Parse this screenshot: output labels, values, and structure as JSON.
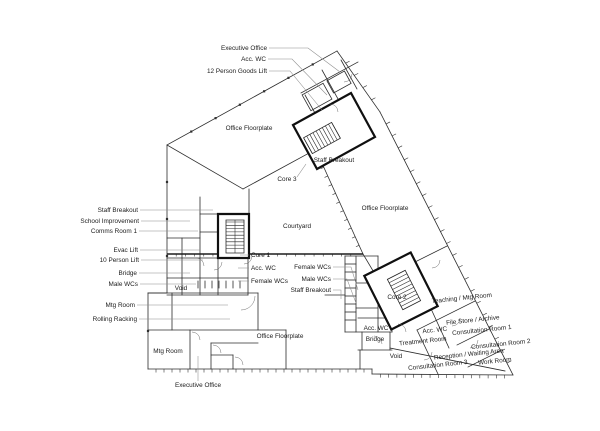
{
  "figure": {
    "type": "architectural-floor-plan",
    "background": "#ffffff",
    "wall_color": "#2b2b2b",
    "text_color": "#1c1c1c"
  },
  "labels": [
    {
      "id": "executive-office-top",
      "text": "Executive Office",
      "x": 267,
      "y": 50,
      "anchor": "end",
      "leader": [
        [
          269,
          48
        ],
        [
          308,
          48
        ],
        [
          340,
          72
        ]
      ]
    },
    {
      "id": "acc-wc-top",
      "text": "Acc. WC",
      "x": 266,
      "y": 61,
      "anchor": "end",
      "leader": [
        [
          268,
          59
        ],
        [
          292,
          59
        ],
        [
          327,
          95
        ]
      ]
    },
    {
      "id": "goods-lift",
      "text": "12 Person Goods Lift",
      "x": 267,
      "y": 73,
      "anchor": "end",
      "leader": [
        [
          269,
          71
        ],
        [
          290,
          71
        ],
        [
          322,
          110
        ]
      ]
    },
    {
      "id": "office-floorplate-nw",
      "text": "Office Floorplate",
      "x": 249,
      "y": 130,
      "anchor": "middle"
    },
    {
      "id": "staff-breakout-core3",
      "text": "Staff Breakout",
      "x": 334,
      "y": 162,
      "anchor": "middle"
    },
    {
      "id": "core-3",
      "text": "Core 3",
      "x": 287,
      "y": 181,
      "anchor": "middle",
      "leader": [
        [
          297,
          177
        ],
        [
          306,
          164
        ]
      ]
    },
    {
      "id": "office-floorplate-east",
      "text": "Office Floorplate",
      "x": 385,
      "y": 210,
      "anchor": "middle"
    },
    {
      "id": "staff-breakout-west",
      "text": "Staff Breakout",
      "x": 138,
      "y": 212,
      "anchor": "end",
      "leader": [
        [
          140,
          210
        ],
        [
          213,
          210
        ]
      ]
    },
    {
      "id": "school-improvement",
      "text": "School Improvement",
      "x": 139,
      "y": 223,
      "anchor": "end",
      "leader": [
        [
          141,
          221
        ],
        [
          190,
          221
        ]
      ]
    },
    {
      "id": "comms-room-1",
      "text": "Comms Room 1",
      "x": 137,
      "y": 233,
      "anchor": "end",
      "leader": [
        [
          139,
          231
        ],
        [
          198,
          231
        ]
      ]
    },
    {
      "id": "evac-lift",
      "text": "Evac Lift",
      "x": 138,
      "y": 252,
      "anchor": "end",
      "leader": [
        [
          140,
          250
        ],
        [
          200,
          250
        ]
      ]
    },
    {
      "id": "ten-person-lift",
      "text": "10 Person Lift",
      "x": 139,
      "y": 262,
      "anchor": "end",
      "leader": [
        [
          141,
          260
        ],
        [
          203,
          260
        ]
      ]
    },
    {
      "id": "bridge-west",
      "text": "Bridge",
      "x": 137,
      "y": 275,
      "anchor": "end",
      "leader": [
        [
          139,
          273
        ],
        [
          190,
          273
        ]
      ]
    },
    {
      "id": "male-wcs-west",
      "text": "Male WCs",
      "x": 138,
      "y": 286,
      "anchor": "end",
      "leader": [
        [
          140,
          284
        ],
        [
          196,
          284
        ]
      ]
    },
    {
      "id": "void-west",
      "text": "Void",
      "x": 181,
      "y": 290,
      "anchor": "middle"
    },
    {
      "id": "mtg-room-north",
      "text": "Mtg Room",
      "x": 135,
      "y": 307,
      "anchor": "end",
      "leader": [
        [
          137,
          305
        ],
        [
          228,
          305
        ]
      ]
    },
    {
      "id": "rolling-racking",
      "text": "Rolling Racking",
      "x": 137,
      "y": 321,
      "anchor": "end",
      "leader": [
        [
          139,
          319
        ],
        [
          230,
          319
        ]
      ]
    },
    {
      "id": "mtg-room-south",
      "text": "Mtg Room",
      "x": 168,
      "y": 353,
      "anchor": "middle"
    },
    {
      "id": "executive-office-south",
      "text": "Executive Office",
      "x": 198,
      "y": 387,
      "anchor": "middle",
      "leader": [
        [
          198,
          381
        ],
        [
          198,
          356
        ]
      ]
    },
    {
      "id": "courtyard",
      "text": "Courtyard",
      "x": 297,
      "y": 228,
      "anchor": "middle"
    },
    {
      "id": "core-1",
      "text": "Core 1",
      "x": 251,
      "y": 257,
      "anchor": "start",
      "leader": [
        [
          249,
          255
        ],
        [
          240,
          255
        ]
      ]
    },
    {
      "id": "acc-wc-core1",
      "text": "Acc. WC",
      "x": 251,
      "y": 270,
      "anchor": "start",
      "leader": [
        [
          249,
          268
        ],
        [
          238,
          268
        ]
      ]
    },
    {
      "id": "female-wcs-core1",
      "text": "Female WCs",
      "x": 251,
      "y": 283,
      "anchor": "start",
      "leader": [
        [
          249,
          281
        ],
        [
          238,
          281
        ]
      ]
    },
    {
      "id": "female-wcs-mid",
      "text": "Female WCs",
      "x": 331,
      "y": 269,
      "anchor": "end",
      "leader": [
        [
          333,
          267
        ],
        [
          351,
          267
        ],
        [
          358,
          290
        ]
      ]
    },
    {
      "id": "male-wcs-mid",
      "text": "Male WCs",
      "x": 331,
      "y": 281,
      "anchor": "end",
      "leader": [
        [
          333,
          279
        ],
        [
          347,
          279
        ],
        [
          356,
          303
        ]
      ]
    },
    {
      "id": "staff-breakout-mid",
      "text": "Staff Breakout",
      "x": 331,
      "y": 292,
      "anchor": "end",
      "leader": [
        [
          333,
          290
        ],
        [
          341,
          290
        ],
        [
          341,
          299
        ]
      ]
    },
    {
      "id": "office-floorplate-south",
      "text": "Office Floorplate",
      "x": 280,
      "y": 338,
      "anchor": "middle"
    },
    {
      "id": "core-2",
      "text": "Core 2",
      "x": 397,
      "y": 299,
      "anchor": "middle"
    },
    {
      "id": "teaching-mtg-room",
      "text": "Teaching / Mtg Room",
      "x": 462,
      "y": 300,
      "anchor": "middle",
      "rot": -6
    },
    {
      "id": "file-store-archive",
      "text": "File Store / Archive",
      "x": 473,
      "y": 322,
      "anchor": "middle",
      "rot": -6
    },
    {
      "id": "acc-wc-wing",
      "text": "Acc. WC",
      "x": 435,
      "y": 332,
      "anchor": "middle",
      "rot": -6
    },
    {
      "id": "consultation-room-1",
      "text": "Consultation Room 1",
      "x": 482,
      "y": 332,
      "anchor": "middle",
      "rot": -6
    },
    {
      "id": "acc-wc-bridge",
      "text": "Acc. WC",
      "x": 376,
      "y": 330,
      "anchor": "middle"
    },
    {
      "id": "bridge-east",
      "text": "Bridge",
      "x": 375,
      "y": 341,
      "anchor": "middle"
    },
    {
      "id": "treatment-room",
      "text": "Treatment Room",
      "x": 423,
      "y": 343,
      "anchor": "middle",
      "rot": -6
    },
    {
      "id": "consultation-room-2",
      "text": "Consultation Room 2",
      "x": 501,
      "y": 346,
      "anchor": "middle",
      "rot": -6
    },
    {
      "id": "reception-waiting",
      "text": "Reception / Waiting Area",
      "x": 469,
      "y": 356,
      "anchor": "middle",
      "rot": -6
    },
    {
      "id": "void-east",
      "text": "Void",
      "x": 396,
      "y": 358,
      "anchor": "middle"
    },
    {
      "id": "consultation-room-3",
      "text": "Consultation Room 3",
      "x": 438,
      "y": 367,
      "anchor": "middle",
      "rot": -6
    },
    {
      "id": "work-room",
      "text": "Work Room",
      "x": 495,
      "y": 363,
      "anchor": "middle",
      "rot": -6
    }
  ]
}
